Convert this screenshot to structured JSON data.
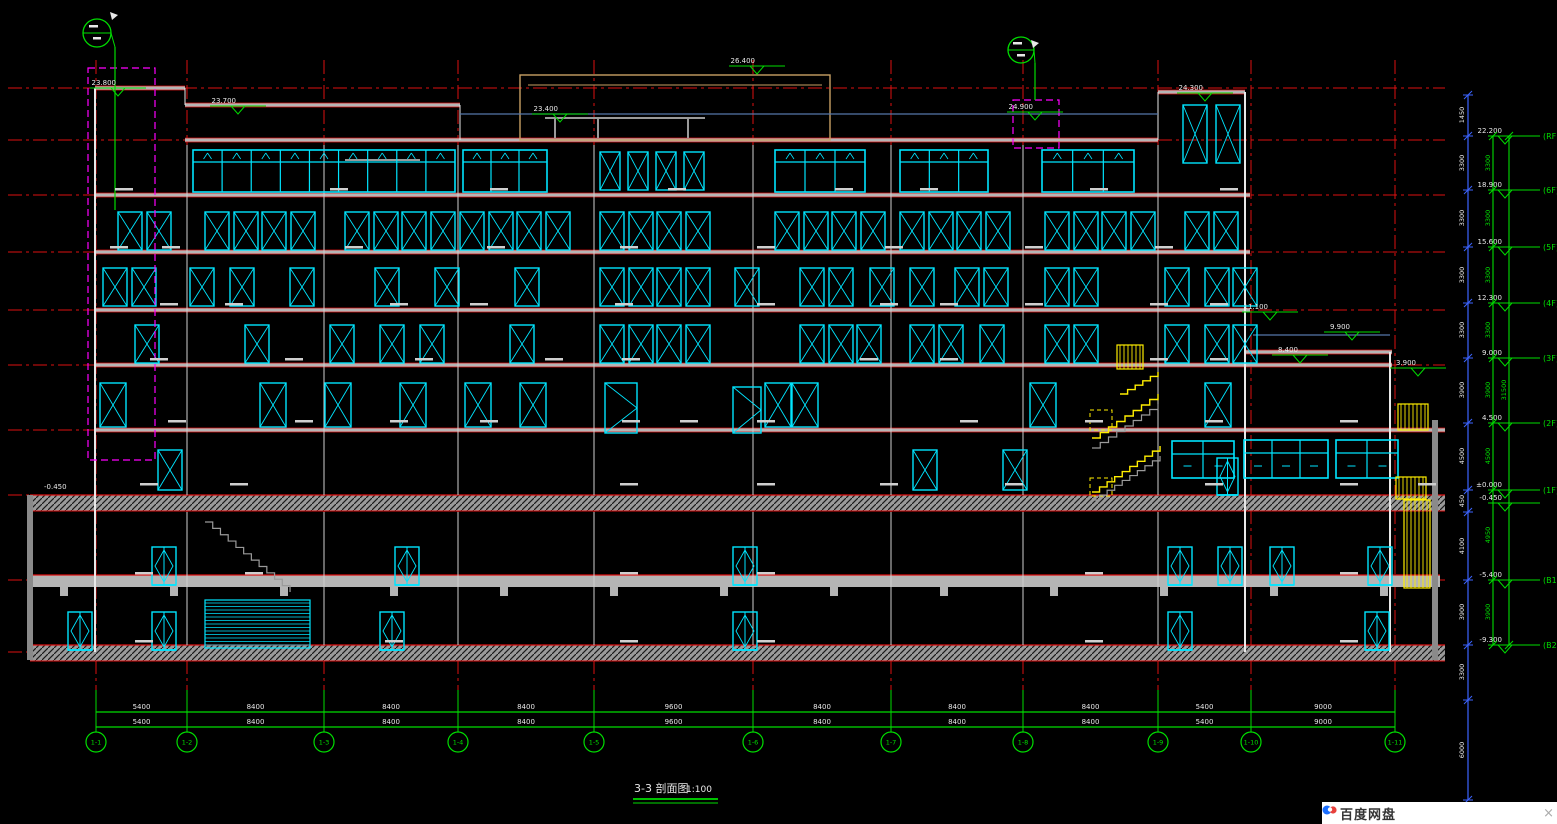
{
  "title": {
    "main": "3-3 剖面图",
    "scale": "1:100"
  },
  "widget": {
    "label": "百度网盘",
    "close": "×"
  },
  "colors": {
    "bg": "#000000",
    "red": "#dd1111",
    "cyan": "#00e5ff",
    "green": "#00dd00",
    "yellow": "#ffee00",
    "magenta": "#ff00ff",
    "blue": "#3c64ff",
    "steel": "#5577aa",
    "gray": "#b5b5b5",
    "white": "#e8e8e8",
    "tan": "#c8a064",
    "mark": "#cfcfcf"
  },
  "drawing": {
    "w": 1557,
    "h": 824,
    "grid_x": [
      96,
      187,
      324,
      458,
      594,
      753,
      891,
      1023,
      1158,
      1251,
      1395
    ],
    "grid_top": 60,
    "grid_red_bottom": 690,
    "grid_green_bottom": 731,
    "level_y": [
      88,
      140,
      195,
      252,
      310,
      365,
      430,
      495,
      580,
      652
    ],
    "level_x1": 8,
    "level_x2": 1445,
    "slabs": [
      [
        95,
        88,
        185
      ],
      [
        185,
        105,
        460
      ],
      [
        185,
        140,
        1158
      ],
      [
        1158,
        92,
        1245
      ],
      [
        95,
        195,
        1250
      ],
      [
        95,
        252,
        1250
      ],
      [
        95,
        310,
        1250
      ],
      [
        95,
        365,
        1392
      ],
      [
        95,
        430,
        1445
      ],
      [
        1245,
        352,
        1392
      ]
    ],
    "hatch_bands": [
      [
        30,
        495,
        1415,
        16
      ],
      [
        30,
        645,
        1415,
        16
      ]
    ],
    "slab_bands": [
      [
        30,
        575,
        1410,
        12
      ]
    ],
    "beam_tabs": [
      60,
      170,
      280,
      390,
      500,
      610,
      720,
      830,
      940,
      1050,
      1160,
      1270,
      1380
    ],
    "beam_tab_y": 587,
    "walls_v": [
      [
        95,
        88,
        652,
        2
      ],
      [
        1245,
        92,
        652,
        2
      ],
      [
        1390,
        352,
        652,
        2
      ],
      [
        185,
        88,
        105,
        1
      ],
      [
        460,
        105,
        140,
        1
      ],
      [
        1158,
        92,
        140,
        1
      ],
      [
        30,
        495,
        660,
        6
      ],
      [
        1435,
        420,
        660,
        6
      ]
    ],
    "col_xs": [
      187,
      324,
      458,
      594,
      753,
      891,
      1023,
      1158
    ],
    "col_y": [
      145,
      495
    ],
    "bcol_y": [
      512,
      645
    ],
    "penthouse": {
      "x": 520,
      "y": 75,
      "w": 310,
      "h": 65
    },
    "gray_lines": [
      [
        545,
        118,
        705,
        118
      ],
      [
        555,
        118,
        555,
        138
      ],
      [
        598,
        118,
        598,
        138
      ],
      [
        688,
        118,
        688,
        138
      ],
      [
        345,
        160,
        420,
        160
      ]
    ],
    "blue_lines": [
      [
        1253,
        335,
        1390,
        335
      ],
      [
        460,
        114,
        1158,
        114
      ]
    ],
    "win_rows": [
      {
        "y": 212,
        "h": 38,
        "w": 24,
        "xs": [
          118,
          147,
          205,
          234,
          262,
          291,
          345,
          374,
          402,
          431,
          460,
          489,
          517,
          546,
          600,
          629,
          657,
          686,
          775,
          804,
          832,
          861,
          900,
          929,
          957,
          986,
          1045,
          1074,
          1102,
          1131,
          1185,
          1214
        ]
      },
      {
        "y": 268,
        "h": 38,
        "w": 24,
        "xs": [
          103,
          132,
          190,
          230,
          290,
          375,
          435,
          515,
          600,
          629,
          657,
          686,
          735,
          800,
          829,
          870,
          910,
          955,
          984,
          1045,
          1074,
          1165,
          1205,
          1233
        ]
      },
      {
        "y": 325,
        "h": 38,
        "w": 24,
        "xs": [
          135,
          245,
          330,
          380,
          420,
          510,
          600,
          629,
          657,
          686,
          800,
          829,
          857,
          910,
          939,
          980,
          1045,
          1074,
          1165,
          1205,
          1233
        ]
      },
      {
        "y": 383,
        "h": 44,
        "w": 26,
        "xs": [
          100,
          260,
          325,
          400,
          465,
          520,
          765,
          792,
          1030,
          1205
        ]
      },
      {
        "y": 450,
        "h": 40,
        "w": 24,
        "xs": [
          158,
          913,
          1003
        ]
      },
      {
        "y": 105,
        "h": 58,
        "w": 24,
        "xs": [
          1183,
          1216
        ]
      },
      {
        "y": 152,
        "h": 38,
        "w": 20,
        "xs": [
          600,
          628,
          656,
          684
        ]
      }
    ],
    "mull_bands": [
      [
        193,
        150,
        262,
        42,
        9
      ],
      [
        463,
        150,
        84,
        42,
        3
      ],
      [
        775,
        150,
        90,
        42,
        3
      ],
      [
        900,
        150,
        88,
        42,
        3
      ],
      [
        1042,
        150,
        92,
        42,
        3
      ]
    ],
    "storefronts": [
      [
        1172,
        441,
        62,
        37,
        2
      ],
      [
        1244,
        440,
        84,
        38,
        3
      ],
      [
        1336,
        440,
        62,
        38,
        2
      ]
    ],
    "doors": [
      [
        605,
        383,
        32,
        50
      ],
      [
        733,
        387,
        28,
        46
      ]
    ],
    "diamond_rows": [
      {
        "y": 547,
        "h": 38,
        "w": 24,
        "xs": [
          152,
          395,
          733,
          1168,
          1218,
          1270,
          1368
        ]
      },
      {
        "y": 612,
        "h": 38,
        "w": 24,
        "xs": [
          68,
          152,
          380,
          733,
          1168,
          1365
        ]
      },
      {
        "y": 458,
        "h": 37,
        "w": 21,
        "xs": [
          1217
        ]
      }
    ],
    "louver": [
      205,
      600,
      105,
      48
    ],
    "yellow_hatch": [
      [
        1117,
        345,
        26,
        24
      ],
      [
        1398,
        404,
        30,
        26
      ],
      [
        1396,
        477,
        30,
        22
      ],
      [
        1404,
        500,
        26,
        88
      ]
    ],
    "yellow_dash_boxes": [
      [
        1090,
        410,
        22,
        20
      ],
      [
        1090,
        478,
        22,
        18
      ]
    ],
    "stairs_yellow": [
      [
        1092,
        438,
        1158,
        394,
        8
      ],
      [
        1092,
        492,
        1160,
        446,
        9
      ],
      [
        1120,
        394,
        1158,
        372,
        5
      ]
    ],
    "stairs_gray": [
      [
        1092,
        448,
        1158,
        404,
        8
      ],
      [
        1092,
        500,
        1160,
        456,
        9
      ],
      [
        205,
        522,
        290,
        592,
        11
      ]
    ],
    "magenta_boxes": [
      [
        88,
        68,
        67,
        392
      ],
      [
        1013,
        100,
        46,
        48
      ]
    ],
    "callouts": [
      {
        "cx": 97,
        "cy": 33,
        "r": 14,
        "sx": 115,
        "sy1": 47,
        "sy2": 210,
        "ax": 110,
        "ay": 12
      },
      {
        "cx": 1021,
        "cy": 50,
        "r": 13,
        "sx": 1035,
        "sy1": 63,
        "sy2": 100,
        "ax": 1031,
        "ay": 40
      }
    ],
    "roof_marks": [
      [
        757,
        66,
        "26.400"
      ],
      [
        560,
        114,
        "23.400"
      ],
      [
        238,
        106,
        "23.700"
      ],
      [
        118,
        88,
        "23.800"
      ],
      [
        1035,
        112,
        "24.900"
      ],
      [
        1205,
        93,
        "24.300"
      ],
      [
        1270,
        312,
        "11.100"
      ],
      [
        1352,
        332,
        "9.900"
      ],
      [
        1300,
        355,
        "8.400"
      ],
      [
        1418,
        368,
        "3.900"
      ]
    ],
    "right_stack": {
      "lx1": 1488,
      "lx2": 1540,
      "tx": 1505,
      "tagx": 1543,
      "items": [
        [
          136,
          "22.200",
          "(RF)"
        ],
        [
          190,
          "18.900",
          "(6F)"
        ],
        [
          247,
          "15.600",
          "(5F)"
        ],
        [
          303,
          "12.300",
          "(4F)"
        ],
        [
          358,
          "9.000",
          "(3F)"
        ],
        [
          423,
          "4.500",
          "(2F)"
        ],
        [
          490,
          "±0.000",
          "(1F)"
        ],
        [
          503,
          "-0.450",
          ""
        ],
        [
          580,
          "-5.400",
          "(B1)"
        ],
        [
          645,
          "-9.300",
          "(B2)"
        ]
      ]
    },
    "blue_chain": {
      "x": 1468,
      "y1": 95,
      "y2": 800,
      "ticks": [
        95,
        136,
        190,
        247,
        303,
        358,
        423,
        490,
        512,
        580,
        645,
        700,
        800
      ],
      "values": [
        [
          "1450",
          115
        ],
        [
          "3300",
          163
        ],
        [
          "3300",
          218
        ],
        [
          "3300",
          275
        ],
        [
          "3300",
          330
        ],
        [
          "3900",
          390
        ],
        [
          "4500",
          456
        ],
        [
          "450",
          501
        ],
        [
          "4100",
          546
        ],
        [
          "3900",
          612
        ],
        [
          "3300",
          672
        ],
        [
          "6000",
          750
        ]
      ]
    },
    "green_chains": [
      {
        "x": 1493,
        "ticks": [
          136,
          190,
          247,
          303,
          358,
          423,
          490,
          580,
          645
        ],
        "values": [
          [
            "3300",
            163
          ],
          [
            "3300",
            218
          ],
          [
            "3300",
            275
          ],
          [
            "3300",
            330
          ],
          [
            "3900",
            390
          ],
          [
            "4500",
            456
          ],
          [
            "4950",
            535
          ],
          [
            "3900",
            612
          ]
        ]
      },
      {
        "x": 1509,
        "ticks": [
          136,
          645
        ],
        "values": [
          [
            "31500",
            390
          ]
        ]
      }
    ],
    "bottom_dims": {
      "rows": [
        712,
        727
      ],
      "stub_top": 695,
      "labels": [
        "5400",
        "8400",
        "8400",
        "8400",
        "9600",
        "8400",
        "8400",
        "8400",
        "5400",
        "9000"
      ]
    },
    "bubbles": {
      "y": 742,
      "r": 10,
      "labels": [
        "1-1",
        "1-2",
        "1-3",
        "1-4",
        "1-5",
        "1-6",
        "1-7",
        "1-8",
        "1-9",
        "1-10",
        "1-11"
      ]
    },
    "grade_text": [
      [
        44,
        489,
        "-0.450"
      ]
    ],
    "title_pos": {
      "x": 634,
      "y": 792,
      "sx": 686,
      "ul": [
        [
          633,
          799,
          718
        ],
        [
          633,
          803,
          718
        ]
      ]
    },
    "marks": [
      [
        115,
        188
      ],
      [
        330,
        188
      ],
      [
        490,
        188
      ],
      [
        668,
        188
      ],
      [
        835,
        188
      ],
      [
        920,
        188
      ],
      [
        1090,
        188
      ],
      [
        1220,
        188
      ],
      [
        110,
        246
      ],
      [
        162,
        246
      ],
      [
        345,
        246
      ],
      [
        487,
        246
      ],
      [
        620,
        246
      ],
      [
        757,
        246
      ],
      [
        885,
        246
      ],
      [
        1025,
        246
      ],
      [
        1155,
        246
      ],
      [
        160,
        303
      ],
      [
        225,
        303
      ],
      [
        390,
        303
      ],
      [
        470,
        303
      ],
      [
        615,
        303
      ],
      [
        757,
        303
      ],
      [
        880,
        303
      ],
      [
        940,
        303
      ],
      [
        1025,
        303
      ],
      [
        1150,
        303
      ],
      [
        1210,
        303
      ],
      [
        150,
        358
      ],
      [
        285,
        358
      ],
      [
        415,
        358
      ],
      [
        545,
        358
      ],
      [
        622,
        358
      ],
      [
        860,
        358
      ],
      [
        940,
        358
      ],
      [
        1150,
        358
      ],
      [
        1210,
        358
      ],
      [
        168,
        420
      ],
      [
        295,
        420
      ],
      [
        390,
        420
      ],
      [
        480,
        420
      ],
      [
        622,
        420
      ],
      [
        680,
        420
      ],
      [
        757,
        420
      ],
      [
        960,
        420
      ],
      [
        1085,
        420
      ],
      [
        1205,
        420
      ],
      [
        1340,
        420
      ],
      [
        140,
        483
      ],
      [
        230,
        483
      ],
      [
        620,
        483
      ],
      [
        757,
        483
      ],
      [
        880,
        483
      ],
      [
        1005,
        483
      ],
      [
        1205,
        483
      ],
      [
        1340,
        483
      ],
      [
        1418,
        483
      ],
      [
        135,
        572
      ],
      [
        245,
        572
      ],
      [
        620,
        572
      ],
      [
        757,
        572
      ],
      [
        1085,
        572
      ],
      [
        1340,
        572
      ],
      [
        135,
        640
      ],
      [
        385,
        640
      ],
      [
        620,
        640
      ],
      [
        757,
        640
      ],
      [
        1085,
        640
      ],
      [
        1340,
        640
      ]
    ]
  }
}
